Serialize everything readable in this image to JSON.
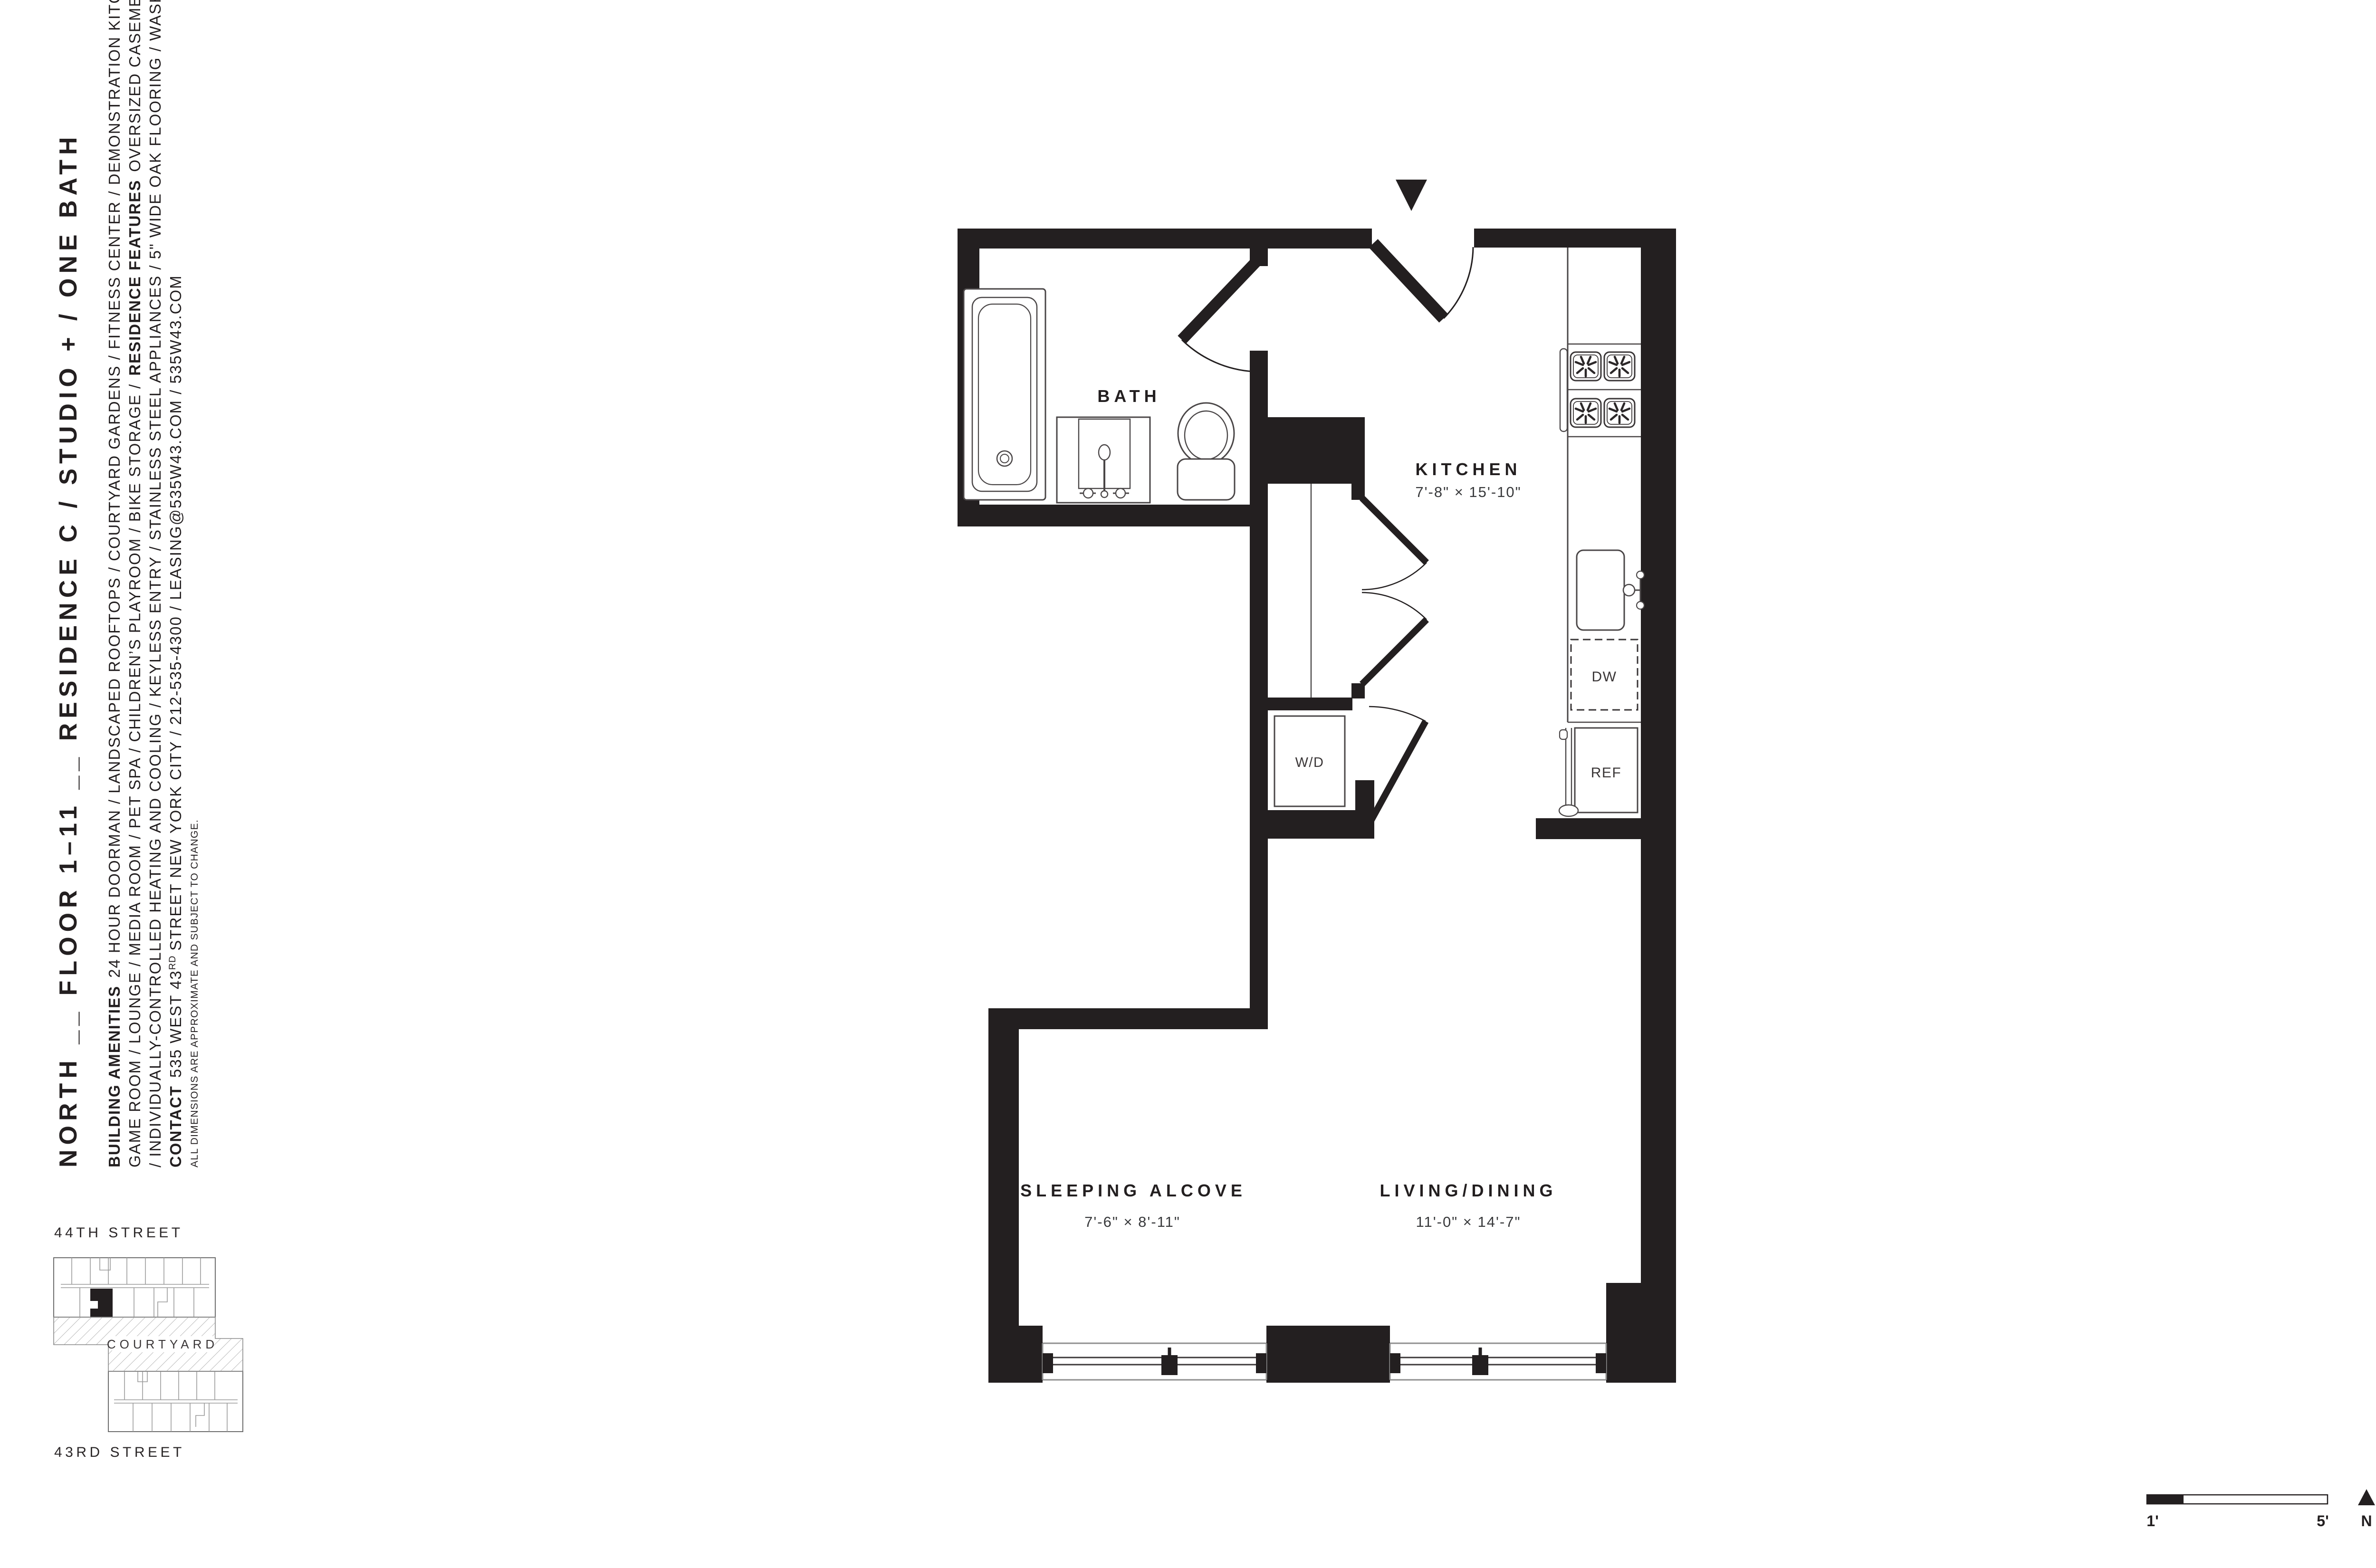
{
  "page": {
    "background": "#ffffff",
    "ink": "#231f20"
  },
  "sidebar": {
    "title": "NORTH __ FLOOR 1–11 __ RESIDENCE C / STUDIO + / ONE BATH",
    "amenities1": {
      "label": "BUILDING AMENITIES",
      "text": "24 HOUR DOORMAN / LANDSCAPED ROOFTOPS / COURTYARD GARDENS / FITNESS CENTER / DEMONSTRATION KITCHEN /"
    },
    "amenities2": {
      "text_before": "GAME ROOM / LOUNGE / MEDIA ROOM / PET SPA / CHILDREN’S PLAYROOM / BIKE STORAGE /",
      "label": "RESIDENCE FEATURES",
      "text_after": "OVERSIZED CASEMENT WINDOWS"
    },
    "amenities3": {
      "text": "/ INDIVIDUALLY-CONTROLLED HEATING AND COOLING / KEYLESS ENTRY / STAINLESS STEEL APPLIANCES / 5\" WIDE OAK FLOORING / WASHER+DRYER /"
    },
    "contact": {
      "label": "CONTACT",
      "address": "535 WEST 43",
      "ordinal": "RD",
      "rest": "STREET NEW YORK CITY / 212-535-4300 / LEASING@535W43.COM / 535W43.COM"
    },
    "disclaimer": "ALL DIMENSIONS ARE APPROXIMATE AND SUBJECT TO CHANGE."
  },
  "plan": {
    "rooms": {
      "bath": {
        "label": "BATH"
      },
      "kitchen": {
        "label": "KITCHEN",
        "dims": "7'-8\" × 15'-10\""
      },
      "sleeping_alcove": {
        "label": "SLEEPING ALCOVE",
        "dims": "7'-6\" × 8'-11\""
      },
      "living_dining": {
        "label": "LIVING/DINING",
        "dims": "11'-0\" × 14'-7\""
      }
    },
    "appliances": {
      "washer_dryer": "W/D",
      "dishwasher": "DW",
      "refrigerator": "REF"
    }
  },
  "key_map": {
    "street_top": "44TH STREET",
    "street_bottom": "43RD STREET",
    "courtyard": "COURTYARD"
  },
  "scale_bar": {
    "start": "1'",
    "end": "5'",
    "north": "N"
  }
}
